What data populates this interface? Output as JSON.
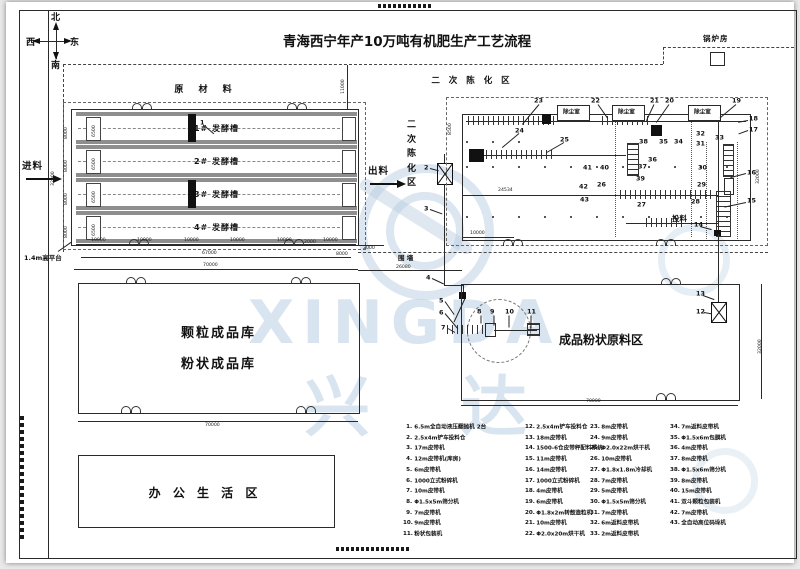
{
  "title": "青海西宁年产10万吨有机肥生产工艺流程",
  "compass": {
    "north": "北",
    "south": "南",
    "west": "西",
    "east": "东"
  },
  "areas": {
    "boiler_room": "锅炉房",
    "raw_material": "原 材 料",
    "secondary_aging": "二 次 陈 化 区",
    "secondary_aging_vertical": "二次陈化区",
    "granular_warehouse": "颗粒成品库",
    "powder_warehouse": "粉状成品库",
    "finished_powder_area": "成品粉状原料区",
    "office_area": "办 公 生 活 区",
    "fence": "围 墙",
    "platform": "1.4m高平台",
    "feed_in": "进料",
    "discharge": "出料",
    "feeding": "投料",
    "dust_room": "除尘室"
  },
  "watermark": {
    "text_en": "XINGDA",
    "text_cn": "兴  达"
  },
  "fermentation": {
    "tanks": [
      {
        "label": "1# 发酵槽",
        "inner_dim": "6500",
        "row_dim": "8000"
      },
      {
        "label": "2# 发酵槽",
        "inner_dim": "6500",
        "row_dim": "8000"
      },
      {
        "label": "3# 发酵槽",
        "inner_dim": "6500",
        "row_dim": "8000"
      },
      {
        "label": "4# 发酵槽",
        "inner_dim": "6500",
        "row_dim": "8000"
      }
    ]
  },
  "dust_rooms": {
    "label": "除尘室",
    "xs": [
      551,
      606,
      682
    ]
  },
  "dimensions": [
    {
      "t": "32000",
      "x": 44,
      "y": 184,
      "r": 1
    },
    {
      "t": "10000",
      "x": 85,
      "y": 235
    },
    {
      "t": "10000",
      "x": 131,
      "y": 235
    },
    {
      "t": "10000",
      "x": 178,
      "y": 235
    },
    {
      "t": "10000",
      "x": 224,
      "y": 235
    },
    {
      "t": "10000",
      "x": 271,
      "y": 235
    },
    {
      "t": "10000",
      "x": 317,
      "y": 235
    },
    {
      "t": "67000",
      "x": 196,
      "y": 248
    },
    {
      "t": "70000",
      "x": 197,
      "y": 260
    },
    {
      "t": "2000",
      "x": 298,
      "y": 237
    },
    {
      "t": "8000",
      "x": 330,
      "y": 249
    },
    {
      "t": "2000",
      "x": 357,
      "y": 243
    },
    {
      "t": "11000",
      "x": 334,
      "y": 92,
      "r": 1
    },
    {
      "t": "26080",
      "x": 390,
      "y": 262
    },
    {
      "t": "24534",
      "x": 492,
      "y": 185
    },
    {
      "t": "10000",
      "x": 464,
      "y": 228
    },
    {
      "t": "8500",
      "x": 441,
      "y": 133,
      "r": 1
    },
    {
      "t": "32000",
      "x": 749,
      "y": 182,
      "r": 1
    },
    {
      "t": "32000",
      "x": 751,
      "y": 352,
      "r": 1
    },
    {
      "t": "70000",
      "x": 199,
      "y": 420
    },
    {
      "t": "70000",
      "x": 580,
      "y": 396
    }
  ],
  "annotations": [
    {
      "n": "1",
      "x": 194,
      "y": 117
    },
    {
      "n": "2",
      "x": 418,
      "y": 162
    },
    {
      "n": "3",
      "x": 418,
      "y": 203
    },
    {
      "n": "4",
      "x": 420,
      "y": 272
    },
    {
      "n": "5",
      "x": 433,
      "y": 295
    },
    {
      "n": "6",
      "x": 433,
      "y": 307
    },
    {
      "n": "7",
      "x": 435,
      "y": 322
    },
    {
      "n": "8",
      "x": 471,
      "y": 306
    },
    {
      "n": "9",
      "x": 484,
      "y": 306
    },
    {
      "n": "10",
      "x": 499,
      "y": 306
    },
    {
      "n": "11",
      "x": 521,
      "y": 306
    },
    {
      "n": "12",
      "x": 690,
      "y": 306
    },
    {
      "n": "13",
      "x": 690,
      "y": 288
    },
    {
      "n": "14",
      "x": 688,
      "y": 219
    },
    {
      "n": "15",
      "x": 741,
      "y": 195
    },
    {
      "n": "16",
      "x": 741,
      "y": 167
    },
    {
      "n": "17",
      "x": 743,
      "y": 124
    },
    {
      "n": "18",
      "x": 743,
      "y": 113
    },
    {
      "n": "19",
      "x": 726,
      "y": 95
    },
    {
      "n": "20",
      "x": 659,
      "y": 95
    },
    {
      "n": "21",
      "x": 644,
      "y": 95
    },
    {
      "n": "22",
      "x": 585,
      "y": 95
    },
    {
      "n": "23",
      "x": 528,
      "y": 95
    },
    {
      "n": "24",
      "x": 509,
      "y": 125
    },
    {
      "n": "25",
      "x": 554,
      "y": 134
    },
    {
      "n": "26",
      "x": 591,
      "y": 179
    },
    {
      "n": "27",
      "x": 631,
      "y": 199
    },
    {
      "n": "28",
      "x": 685,
      "y": 196
    },
    {
      "n": "29",
      "x": 691,
      "y": 179
    },
    {
      "n": "30",
      "x": 692,
      "y": 162
    },
    {
      "n": "31",
      "x": 690,
      "y": 138
    },
    {
      "n": "32",
      "x": 690,
      "y": 128
    },
    {
      "n": "33",
      "x": 709,
      "y": 132
    },
    {
      "n": "34",
      "x": 668,
      "y": 136
    },
    {
      "n": "35",
      "x": 653,
      "y": 136
    },
    {
      "n": "36",
      "x": 642,
      "y": 154
    },
    {
      "n": "37",
      "x": 632,
      "y": 161
    },
    {
      "n": "38",
      "x": 633,
      "y": 136
    },
    {
      "n": "39",
      "x": 630,
      "y": 173
    },
    {
      "n": "40",
      "x": 594,
      "y": 162
    },
    {
      "n": "41",
      "x": 577,
      "y": 162
    },
    {
      "n": "42",
      "x": 573,
      "y": 181
    },
    {
      "n": "43",
      "x": 574,
      "y": 194
    }
  ],
  "leaders": [
    {
      "x": 198,
      "y": 123,
      "l": 13,
      "a": 40
    },
    {
      "x": 424,
      "y": 166,
      "l": 9,
      "a": 15
    },
    {
      "x": 424,
      "y": 207,
      "l": 13,
      "a": 20
    },
    {
      "x": 426,
      "y": 276,
      "l": 13,
      "a": 25
    },
    {
      "x": 439,
      "y": 299,
      "l": 16,
      "a": 55
    },
    {
      "x": 439,
      "y": 311,
      "l": 20,
      "a": 50
    },
    {
      "x": 442,
      "y": 326,
      "l": 8,
      "a": 30
    },
    {
      "x": 475,
      "y": 313,
      "l": 8,
      "a": 90
    },
    {
      "x": 488,
      "y": 313,
      "l": 10,
      "a": 90
    },
    {
      "x": 503,
      "y": 313,
      "l": 12,
      "a": 90
    },
    {
      "x": 525,
      "y": 313,
      "l": 13,
      "a": 90
    },
    {
      "x": 698,
      "y": 310,
      "l": 8,
      "a": 10
    },
    {
      "x": 697,
      "y": 293,
      "l": 12,
      "a": 20
    },
    {
      "x": 694,
      "y": 224,
      "l": 12,
      "a": 15
    },
    {
      "x": 740,
      "y": 200,
      "l": 22,
      "a": 168
    },
    {
      "x": 740,
      "y": 171,
      "l": 16,
      "a": 165
    },
    {
      "x": 742,
      "y": 128,
      "l": 10,
      "a": 160
    },
    {
      "x": 742,
      "y": 118,
      "l": 10,
      "a": 170
    },
    {
      "x": 730,
      "y": 102,
      "l": 21,
      "a": 140
    },
    {
      "x": 663,
      "y": 102,
      "l": 22,
      "a": 125
    },
    {
      "x": 648,
      "y": 102,
      "l": 18,
      "a": 115
    },
    {
      "x": 592,
      "y": 102,
      "l": 17,
      "a": 55
    },
    {
      "x": 533,
      "y": 102,
      "l": 26,
      "a": 130
    },
    {
      "x": 513,
      "y": 131,
      "l": 22,
      "a": 140
    },
    {
      "x": 558,
      "y": 140,
      "l": 20,
      "a": 150
    },
    {
      "x": 52,
      "y": 249,
      "l": 16,
      "a": -35
    }
  ],
  "legend": {
    "columns": [
      {
        "items": [
          {
            "no": "1.",
            "text": "6.5m全自动液压翻抛机 2台"
          },
          {
            "no": "2.",
            "text": "2.5x4m铲车投料仓"
          },
          {
            "no": "3.",
            "text": "17m皮带机"
          },
          {
            "no": "4.",
            "text": "12m皮带机(库房)"
          },
          {
            "no": "5.",
            "text": "6m皮带机"
          },
          {
            "no": "6.",
            "text": "1000立式粉碎机"
          },
          {
            "no": "7.",
            "text": "10m皮带机"
          },
          {
            "no": "8.",
            "text": "Φ1.5x5m筛分机"
          },
          {
            "no": "9.",
            "text": "7m皮带机"
          },
          {
            "no": "10.",
            "text": "9m皮带机"
          },
          {
            "no": "11.",
            "text": "粉状包装机"
          }
        ]
      },
      {
        "items": [
          {
            "no": "12.",
            "text": "2.5x4m铲车投料仓"
          },
          {
            "no": "13.",
            "text": "18m皮带机"
          },
          {
            "no": "14.",
            "text": "1500-6仓皮带秤配料系统"
          },
          {
            "no": "15.",
            "text": "11m皮带机"
          },
          {
            "no": "16.",
            "text": "14m皮带机"
          },
          {
            "no": "17.",
            "text": "1000立式粉碎机"
          },
          {
            "no": "18.",
            "text": "4m皮带机"
          },
          {
            "no": "19.",
            "text": "6m皮带机"
          },
          {
            "no": "20.",
            "text": "Φ1.8x2m转鼓造粒机"
          },
          {
            "no": "21.",
            "text": "10m皮带机"
          },
          {
            "no": "22.",
            "text": "Φ2.0x20m烘干机"
          }
        ]
      },
      {
        "items": [
          {
            "no": "23.",
            "text": "8m皮带机"
          },
          {
            "no": "24.",
            "text": "9m皮带机"
          },
          {
            "no": "25.",
            "text": "Φ2.0x22m烘干机"
          },
          {
            "no": "26.",
            "text": "10m皮带机"
          },
          {
            "no": "27.",
            "text": "Φ1.8x1.8m冷却机"
          },
          {
            "no": "28.",
            "text": "7m皮带机"
          },
          {
            "no": "29.",
            "text": "5m皮带机"
          },
          {
            "no": "30.",
            "text": "Φ1.5x5m筛分机"
          },
          {
            "no": "31.",
            "text": "7m皮带机"
          },
          {
            "no": "32.",
            "text": "6m返料皮带机"
          },
          {
            "no": "33.",
            "text": "2m返料皮带机"
          }
        ]
      },
      {
        "items": [
          {
            "no": "34.",
            "text": "7m返料皮带机"
          },
          {
            "no": "35.",
            "text": "Φ1.5x6m包膜机"
          },
          {
            "no": "36.",
            "text": "4m皮带机"
          },
          {
            "no": "37.",
            "text": "8m皮带机"
          },
          {
            "no": "38.",
            "text": "Φ1.5x6m筛分机"
          },
          {
            "no": "39.",
            "text": "8m皮带机"
          },
          {
            "no": "40.",
            "text": "15m皮带机"
          },
          {
            "no": "41.",
            "text": "双斗颗粒包装机"
          },
          {
            "no": "42.",
            "text": "7m皮带机"
          },
          {
            "no": "43.",
            "text": "全自动高位码垛机"
          }
        ]
      }
    ]
  }
}
